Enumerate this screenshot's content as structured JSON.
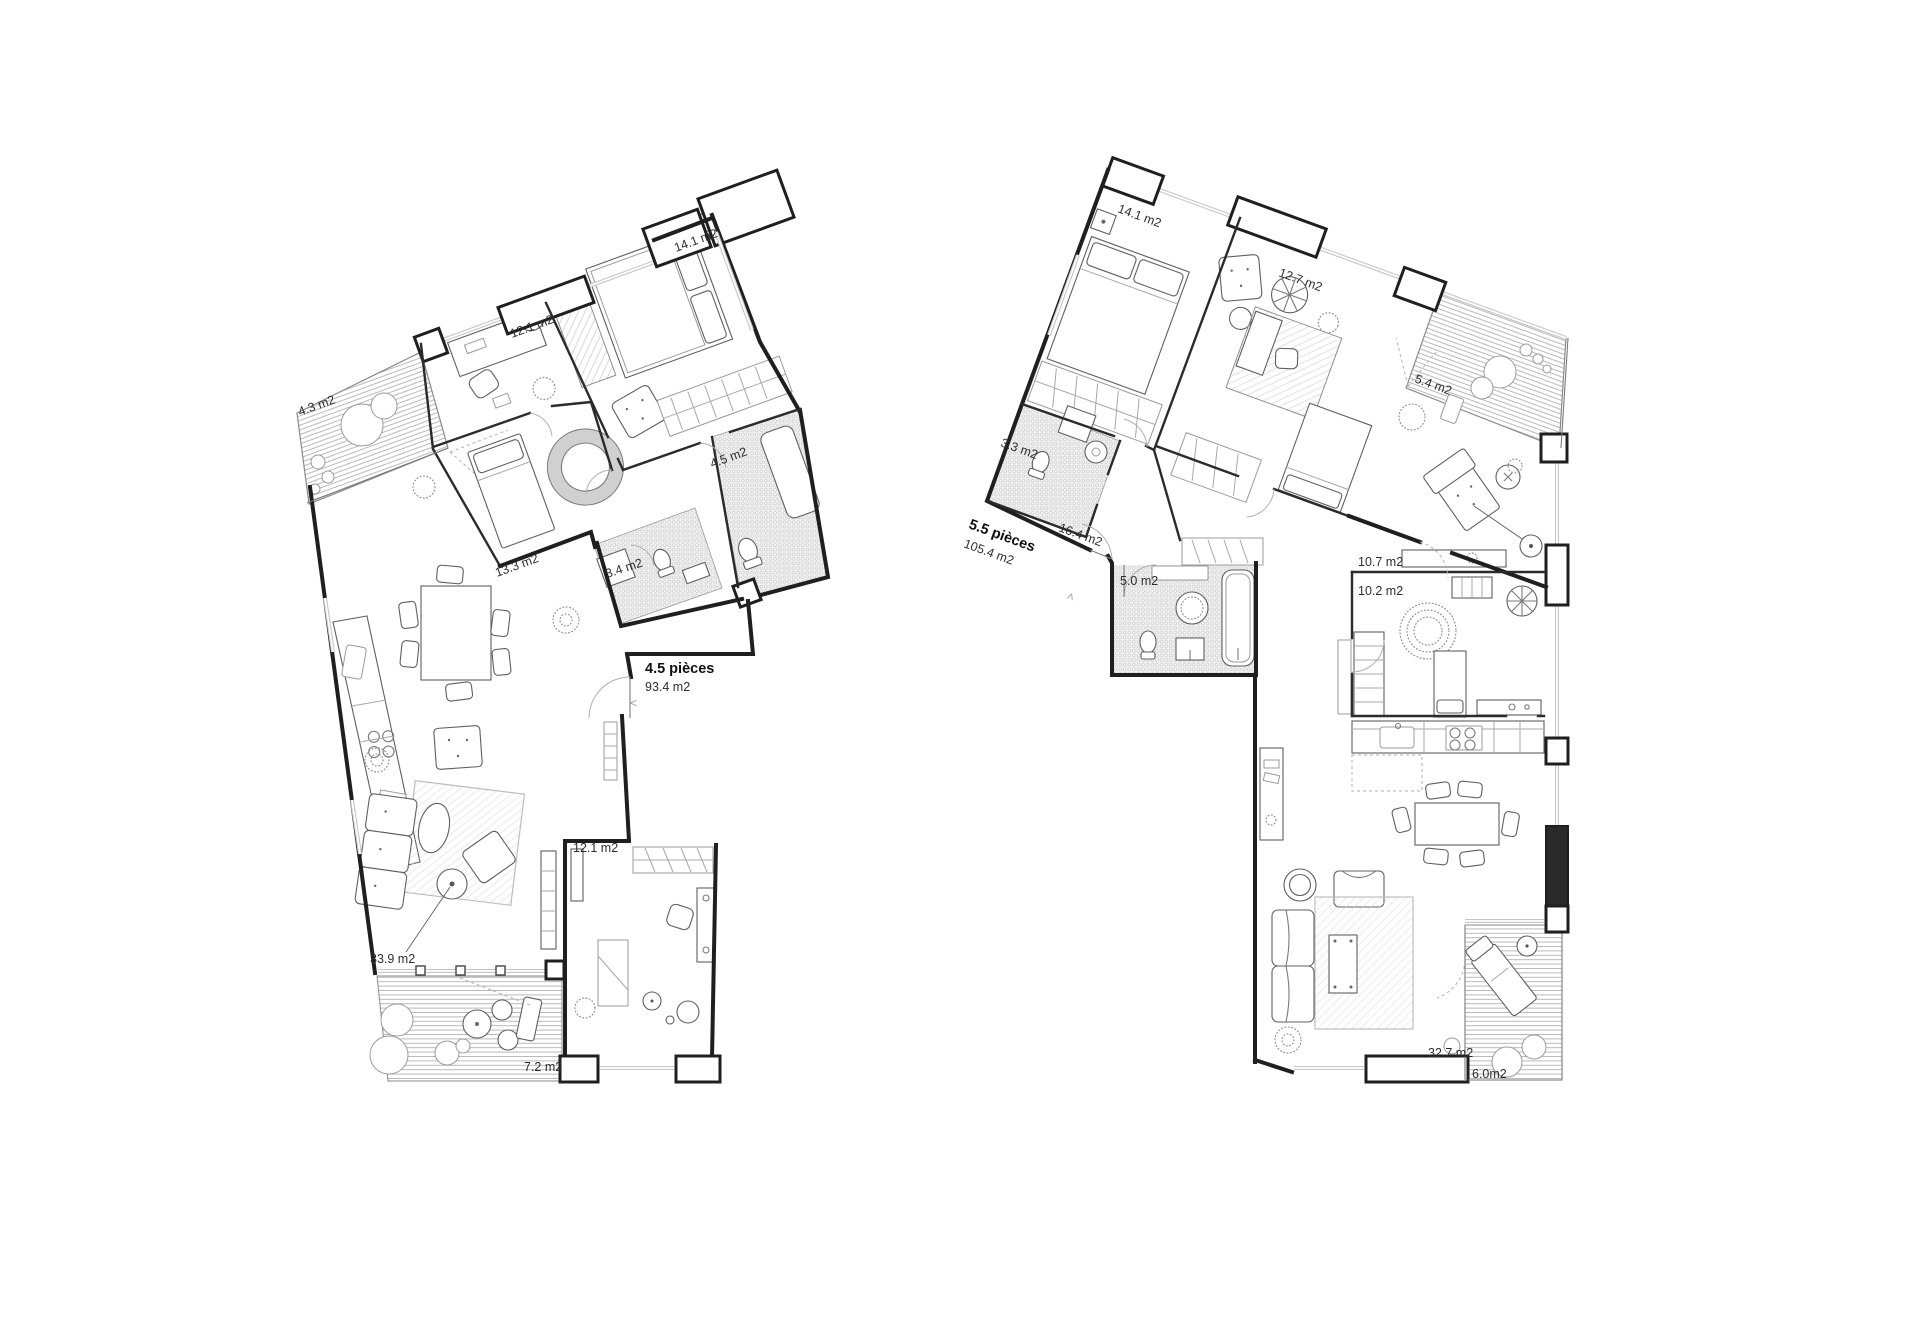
{
  "plans": {
    "left": {
      "title": "4.5 pièces",
      "area": "93.4 m2",
      "rooms": {
        "balcony": "4.3 m2",
        "study": "12.1 m2",
        "bedroom_main": "14.1 m2",
        "bath_large": "4.5 m2",
        "bedroom_small": "13.3 m2",
        "bath_small": "3.4 m2",
        "living": "33.9 m2",
        "office": "12.1 m2",
        "terrace": "7.2 m2"
      },
      "entry_marker": "<"
    },
    "right": {
      "title": "5.5 pièces",
      "area": "105.4 m2",
      "rooms": {
        "bedroom_main": "14.1 m2",
        "bedroom_second": "12.7 m2",
        "balcony": "5.4 m2",
        "bath_small": "3.3 m2",
        "hall": "16.4 m2",
        "bath_main": "5.0 m2",
        "room_upper": "10.7 m2",
        "room_lower": "10.2 m2",
        "living": "32.7 m2",
        "terrace": "6.0m2"
      },
      "entry_marker": "<"
    }
  }
}
